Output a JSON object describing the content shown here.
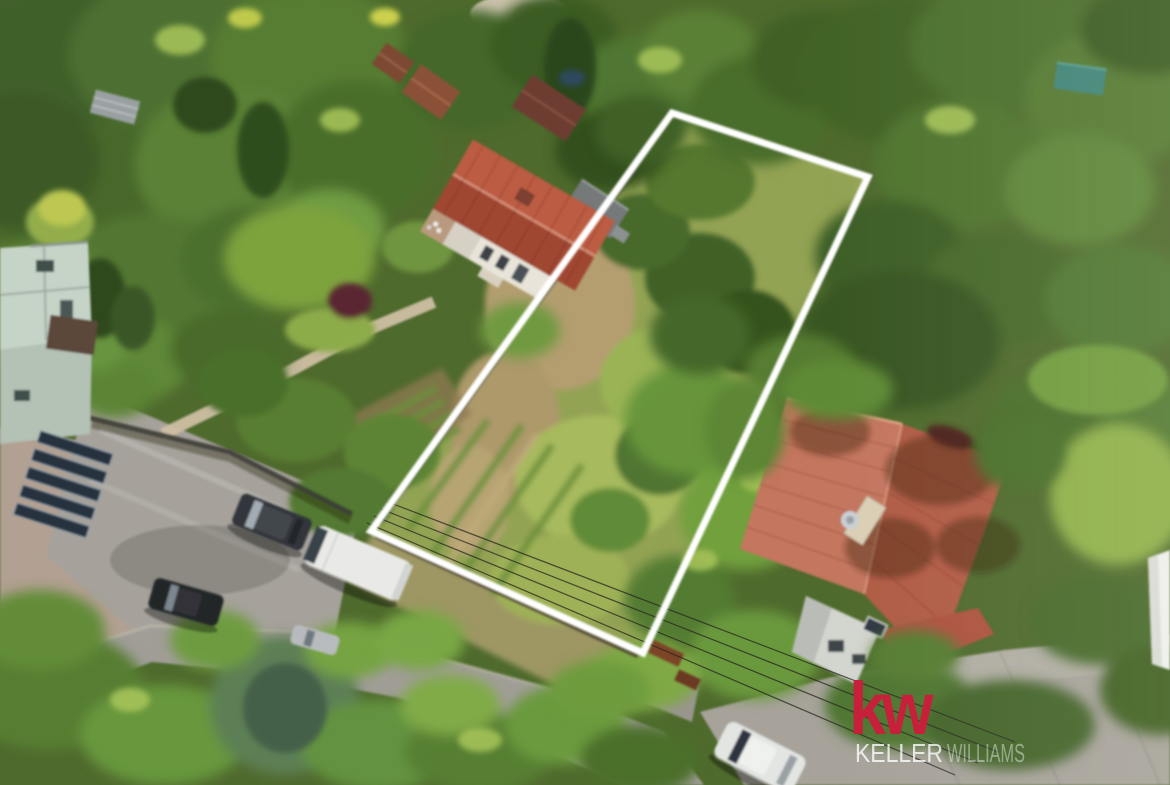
{
  "scene": {
    "label": "Aerial drone photo of a residential garden area with a vacant building plot marked for sale"
  },
  "plot_outline": {
    "points": "672,113 868,177 643,653 371,531",
    "color": "#ffffff"
  },
  "watermark": {
    "logo": "kw",
    "logo_color": "#c7203a",
    "brand_first": "KELLER",
    "brand_second": "WILLIAMS"
  }
}
